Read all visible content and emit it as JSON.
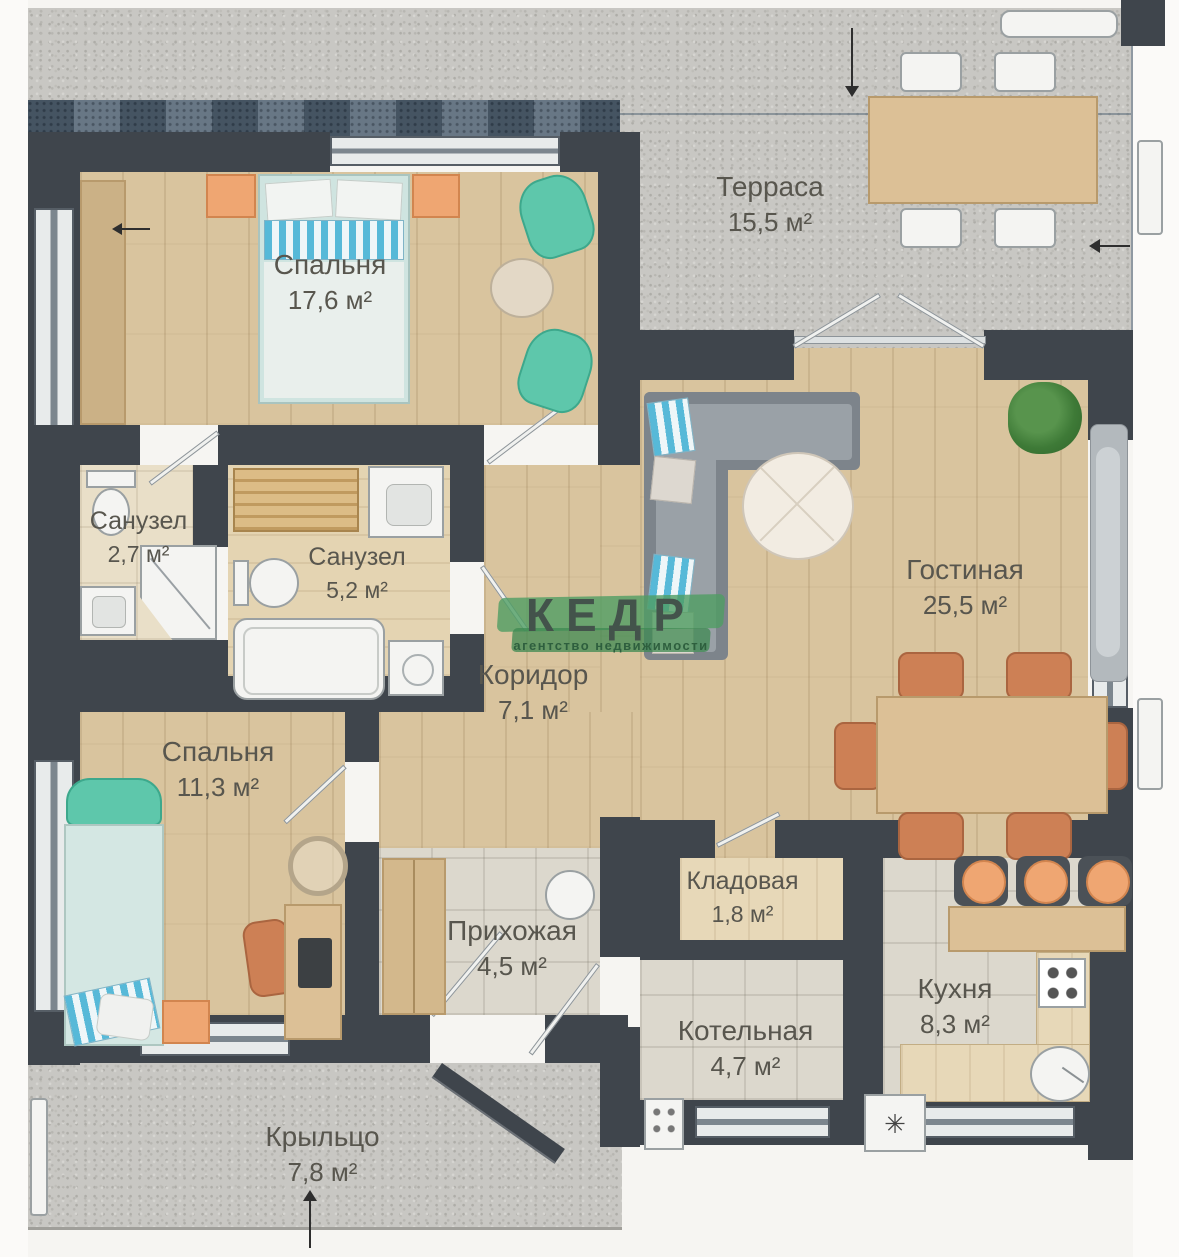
{
  "watermark": {
    "brand": "КЕДР",
    "subtitle": "агентство недвижимости",
    "accent_color": "#3f8a58"
  },
  "icons": {
    "snowflake": "✳"
  },
  "rooms": [
    {
      "id": "terrace",
      "name": "Терраса",
      "area": "15,5 м²"
    },
    {
      "id": "bedroom-main",
      "name": "Спальня",
      "area": "17,6 м²"
    },
    {
      "id": "bathroom-small",
      "name": "Санузел",
      "area": "2,7 м²"
    },
    {
      "id": "bathroom-large",
      "name": "Санузел",
      "area": "5,2 м²"
    },
    {
      "id": "corridor",
      "name": "Коридор",
      "area": "7,1 м²"
    },
    {
      "id": "living-room",
      "name": "Гостиная",
      "area": "25,5 м²"
    },
    {
      "id": "bedroom-second",
      "name": "Спальня",
      "area": "11,3 м²"
    },
    {
      "id": "storage",
      "name": "Кладовая",
      "area": "1,8 м²"
    },
    {
      "id": "hallway",
      "name": "Прихожая",
      "area": "4,5 м²"
    },
    {
      "id": "boiler-room",
      "name": "Котельная",
      "area": "4,7 м²"
    },
    {
      "id": "kitchen",
      "name": "Кухня",
      "area": "8,3 м²"
    },
    {
      "id": "porch",
      "name": "Крыльцо",
      "area": "7,8 м²"
    }
  ]
}
